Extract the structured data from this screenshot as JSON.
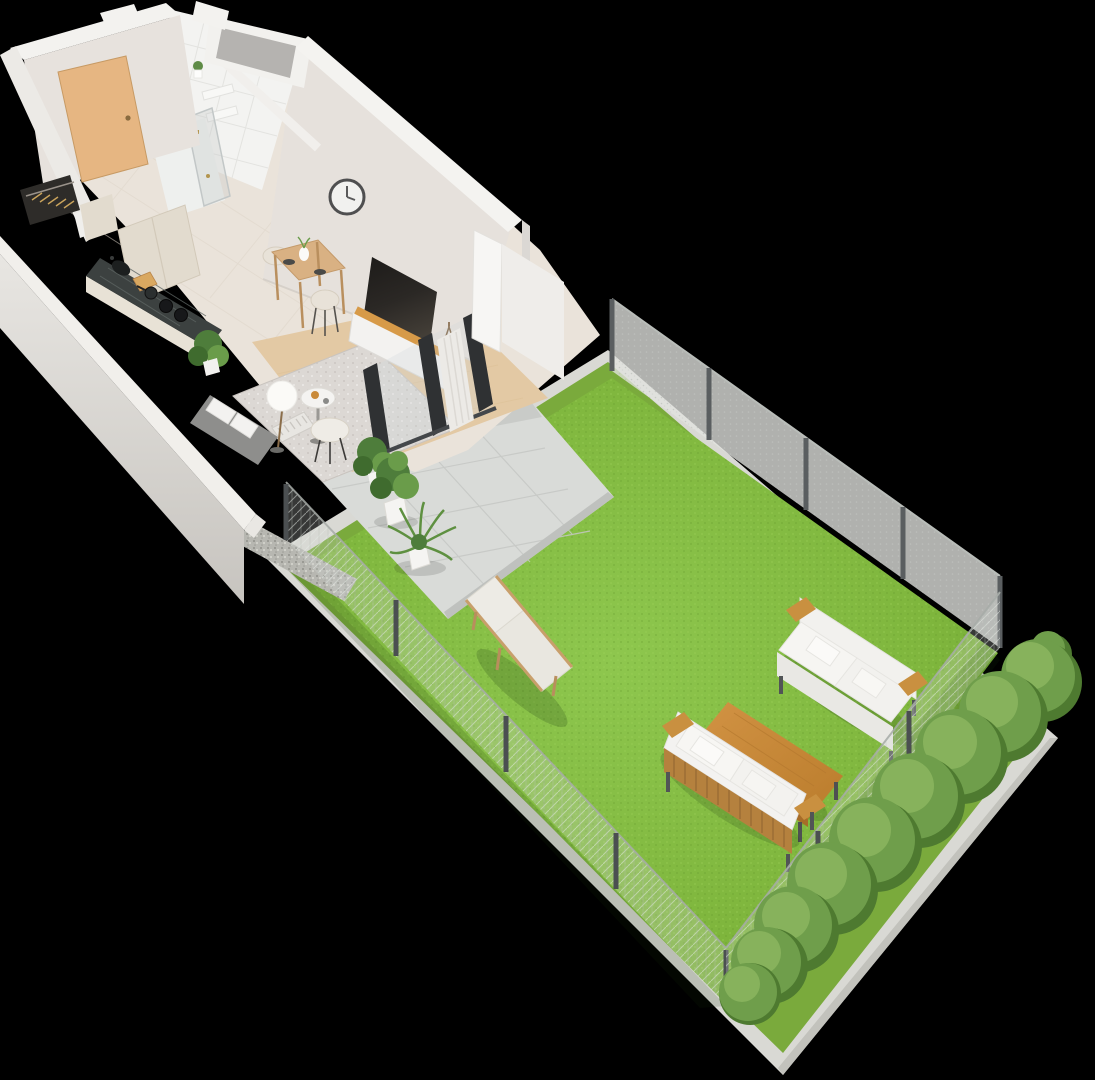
{
  "meta": {
    "type": "isometric-3d-floorplan-render",
    "view": "bird's-eye isometric",
    "width_px": 1095,
    "height_px": 1080,
    "background": "#000000"
  },
  "palette": {
    "background": "#000000",
    "wall_top": "#f3f2ef",
    "wall_face": "#e7e2dd",
    "wall_face_light": "#eceae6",
    "wall_outer": "#e4e2de",
    "interior_wall": "#e6e1dc",
    "tile_wall": "#f3f3f1",
    "niche_gray": "#b5b3b0",
    "floor_tile": "#eae3da",
    "wood_floor": "#e3c9a4",
    "rug": "#dcd8d4",
    "door": "#e6b682",
    "wardrobe": "#2e2c29",
    "counter": "#3c4140",
    "cabinet": "#e2dbce",
    "clock_face": "#f1f1ef",
    "tv": "#242220",
    "sideboard_wood": "#d79a48",
    "sofa_gray": "#8e8e8c",
    "cushion_white": "#f3f2f0",
    "plant_dark": "#3f6b2e",
    "plant_mid": "#4e7d3b",
    "plant_light": "#6a9c4a",
    "patio_tile": "#d9dbd8",
    "patio_line": "#c6c8c5",
    "gravel": "#b7b7b1",
    "curb": "#d9d9d4",
    "grass_outer": "#7aaa3c",
    "lawn": "#80b83e",
    "fence_post": "#4b4f51",
    "hedge_dark": "#4e7a30",
    "hedge_mid": "#6f9e4b",
    "hedge_light": "#8ab45e",
    "outdoor_wood": "#c8893a",
    "outdoor_cushion": "#f2f1ee",
    "lounger_fabric": "#edebe5",
    "lounger_wood": "#c89f6b",
    "slat_wood": "#b5813e",
    "curtain": "#eceae6",
    "door_frame": "#2f3133"
  },
  "scene": {
    "areas": [
      {
        "id": "entrance-hall",
        "label": "entrance hall with wooden front door and open wardrobe"
      },
      {
        "id": "bathroom",
        "label": "tiled bathroom with glass shower, shelves and plant"
      },
      {
        "id": "kitchen",
        "label": "kitchen with dark stone counter, sink, hob and tall cabinets"
      },
      {
        "id": "dining-area",
        "label": "small wooden dining table with two cream chairs"
      },
      {
        "id": "living-room",
        "label": "living room with TV wall, sideboard, sofa, rug and wall clock"
      },
      {
        "id": "patio",
        "label": "tiled patio with two potted plants and gravel strip"
      },
      {
        "id": "garden",
        "label": "fenced lawn with sun lounger, lounge set and hedge"
      }
    ],
    "furniture": [
      "front-door",
      "wardrobe",
      "shower",
      "kitchen-counter",
      "sink",
      "hob",
      "cutting-board",
      "tall-cabinets",
      "dining-table",
      "dining-chairs",
      "wall-clock",
      "tv",
      "tv-sideboard",
      "gray-sofa",
      "radiator",
      "floor-lamp",
      "side-table",
      "lounge-chair",
      "area-rug",
      "indoor-plant",
      "sliding-doors",
      "curtain",
      "potted-plant-fiddle",
      "potted-plant-palm",
      "sun-lounger",
      "garden-sofa-far",
      "garden-sofa-near",
      "garden-coffee-table",
      "mesh-fence",
      "fence-posts",
      "hedge-row"
    ]
  }
}
